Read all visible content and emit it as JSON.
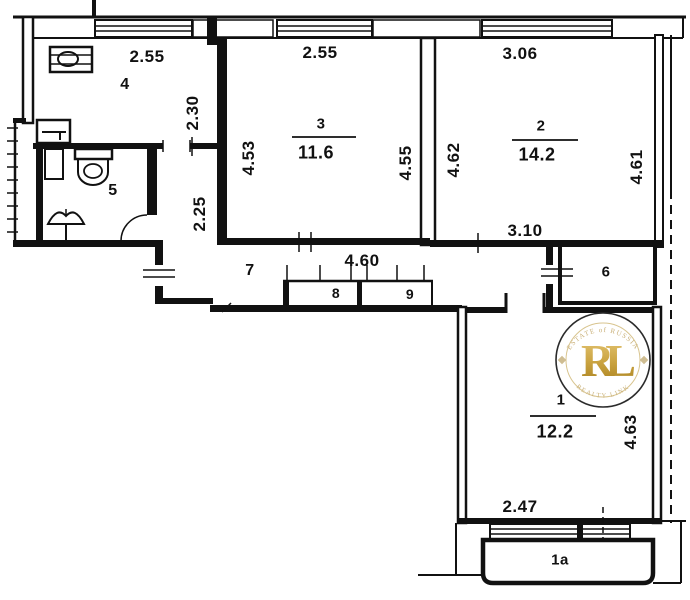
{
  "plan_title": "apartment-floor-plan",
  "rooms": {
    "kitchen": {
      "number": "4",
      "dim_top": "2.55",
      "dim_right": "2.30"
    },
    "bath": {
      "number": "5"
    },
    "living3": {
      "number": "3",
      "area": "11.6",
      "dim_top": "2.55",
      "dim_left": "4.53",
      "dim_right": "4.55"
    },
    "living2": {
      "number": "2",
      "area": "14.2",
      "dim_top": "3.06",
      "dim_left": "4.62",
      "dim_right": "4.61",
      "dim_bottom": "3.10"
    },
    "corridor": {
      "number": "7",
      "dim_width": "4.60",
      "dim_strip": "2.25"
    },
    "closet8": {
      "number": "8"
    },
    "closet9": {
      "number": "9"
    },
    "room6": {
      "number": "6"
    },
    "living1": {
      "number": "1",
      "area": "12.2",
      "dim_right": "4.63",
      "dim_bottom": "2.47"
    },
    "balcony": {
      "number": "1a"
    }
  },
  "watermark": {
    "monogram": "RL",
    "arc_top": "ESTATE of RUSSIA",
    "arc_bottom": "REALTY LINK"
  },
  "colors": {
    "ink": "#111111",
    "gold": "#c9a23f",
    "gold_light": "#d8c48e"
  }
}
